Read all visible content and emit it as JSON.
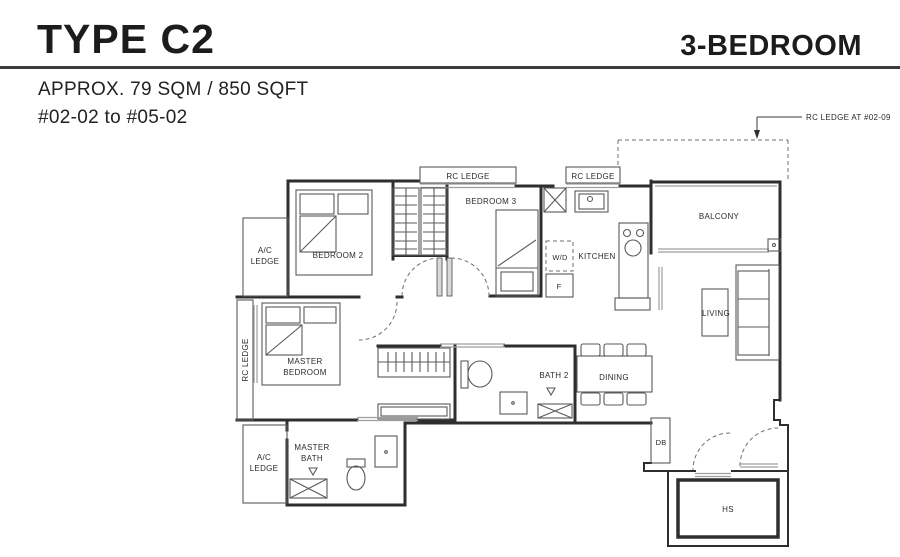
{
  "header": {
    "type": "TYPE C2",
    "category": "3-BEDROOM",
    "area": "APPROX. 79 SQM / 850 SQFT",
    "units": "#02-02 to #05-02"
  },
  "plan": {
    "callout": "RC LEDGE AT #02-09",
    "labels": {
      "rc_ledge_a": "RC LEDGE",
      "rc_ledge_b": "RC LEDGE",
      "rc_ledge_side": "RC LEDGE",
      "ac_ledge_1_line1": "A/C",
      "ac_ledge_1_line2": "LEDGE",
      "ac_ledge_2_line1": "A/C",
      "ac_ledge_2_line2": "LEDGE",
      "bedroom2": "BEDROOM 2",
      "bedroom3": "BEDROOM 3",
      "master_line1": "MASTER",
      "master_line2": "BEDROOM",
      "masterbath_line1": "MASTER",
      "masterbath_line2": "BATH",
      "bath2": "BATH 2",
      "kitchen": "KITCHEN",
      "wd": "W/D",
      "f": "F",
      "balcony": "BALCONY",
      "living": "LIVING",
      "dining": "DINING",
      "db": "DB",
      "hs": "HS"
    },
    "colors": {
      "wall": "#2e2e2e",
      "fixture": "#5a5a5a",
      "glazing": "#9e9e9e",
      "text": "#2b2b2b",
      "rule": "#3c3c3c"
    }
  }
}
